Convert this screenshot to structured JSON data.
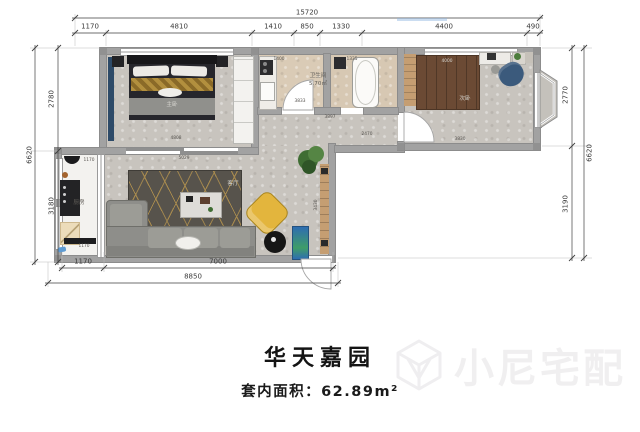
{
  "meta": {
    "title": "华天嘉园",
    "area_text": "套内面积：62.89m²",
    "watermark": "小尼宅配"
  },
  "dimensions": {
    "top": {
      "total": {
        "t": "15720",
        "x": 307,
        "y": 13
      },
      "segments": [
        {
          "t": "1170",
          "x": 90,
          "y": 27
        },
        {
          "t": "4810",
          "x": 179,
          "y": 27
        },
        {
          "t": "1410",
          "x": 273,
          "y": 27
        },
        {
          "t": "850",
          "x": 307,
          "y": 27
        },
        {
          "t": "1330",
          "x": 341,
          "y": 27
        },
        {
          "t": "4400",
          "x": 444,
          "y": 27
        },
        {
          "t": "490",
          "x": 533,
          "y": 27
        }
      ]
    },
    "left": {
      "total": {
        "t": "6620",
        "x": 30,
        "y": 155,
        "r": -90
      },
      "segments": [
        {
          "t": "2780",
          "x": 52,
          "y": 99,
          "r": -90
        },
        {
          "t": "3180",
          "x": 52,
          "y": 206,
          "r": -90
        }
      ]
    },
    "right": {
      "total": {
        "t": "6620",
        "x": 590,
        "y": 153,
        "r": -90
      },
      "segments": [
        {
          "t": "2770",
          "x": 566,
          "y": 95,
          "r": -90
        },
        {
          "t": "3190",
          "x": 566,
          "y": 204,
          "r": -90
        }
      ]
    },
    "bottom": {
      "total": {
        "t": "8850",
        "x": 193,
        "y": 277
      },
      "segments": [
        {
          "t": "1170",
          "x": 83,
          "y": 262
        },
        {
          "t": "7000",
          "x": 218,
          "y": 262
        }
      ]
    }
  },
  "floorplan": {
    "interior_labels": [
      {
        "t": "4808",
        "x": 176,
        "y": 138
      },
      {
        "t": "4000",
        "x": 447,
        "y": 61,
        "light": true
      },
      {
        "t": "3830",
        "x": 460,
        "y": 139
      },
      {
        "t": "3430",
        "x": 316,
        "y": 205,
        "r": -90
      },
      {
        "t": "5029",
        "x": 184,
        "y": 158
      },
      {
        "t": "3833",
        "x": 300,
        "y": 101
      },
      {
        "t": "1400",
        "x": 279,
        "y": 59
      },
      {
        "t": "1335",
        "x": 352,
        "y": 59
      },
      {
        "t": "3897",
        "x": 330,
        "y": 117
      },
      {
        "t": "2470",
        "x": 367,
        "y": 134
      },
      {
        "t": "1170",
        "x": 89,
        "y": 160
      },
      {
        "t": "1170",
        "x": 84,
        "y": 246
      }
    ],
    "room_labels": [
      {
        "t": "主卧",
        "x": 172,
        "y": 105,
        "light": true
      },
      {
        "t": "客厅",
        "x": 233,
        "y": 184,
        "light": true
      },
      {
        "t": "厨房",
        "x": 79,
        "y": 203
      },
      {
        "t": "卫生间",
        "x": 318,
        "y": 76
      },
      {
        "t": "5.70㎡",
        "x": 318,
        "y": 84
      },
      {
        "t": "次卧",
        "x": 465,
        "y": 99,
        "light": true
      }
    ]
  }
}
